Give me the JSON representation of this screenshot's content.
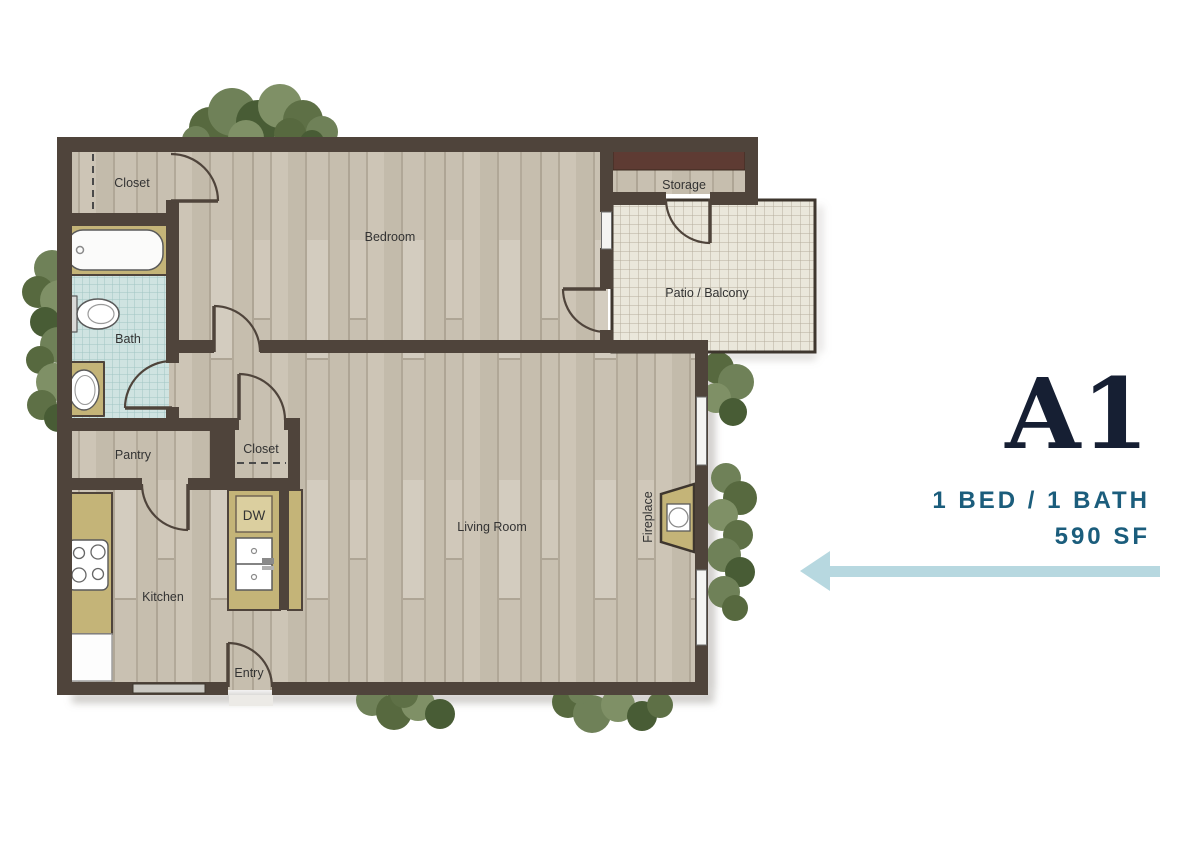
{
  "unit_panel": {
    "unit_name": "A1",
    "bed_bath": "1 BED / 1 BATH",
    "area": "590 SF",
    "name_color": "#161f33",
    "specs_color": "#1b5d7c",
    "arrow_color": "#b7d8e0",
    "arrow_direction": "left"
  },
  "floorplan": {
    "rooms": {
      "bedroom_closet": "Closet",
      "bedroom": "Bedroom",
      "storage": "Storage",
      "patio": "Patio / Balcony",
      "bath": "Bath",
      "pantry": "Pantry",
      "living_closet": "Closet",
      "dishwasher": "DW",
      "kitchen": "Kitchen",
      "living_room": "Living Room",
      "fireplace": "Fireplace",
      "entry": "Entry"
    },
    "colors": {
      "wall": "#4f443b",
      "wood_floor": "#cac2b4",
      "bath_tile": "#cfe3e1",
      "patio_tile": "#eae7db",
      "counter": "#c4b478",
      "storage_shelf": "#5e3b33",
      "foliage": "#6f8158",
      "label_text": "#333333"
    }
  }
}
